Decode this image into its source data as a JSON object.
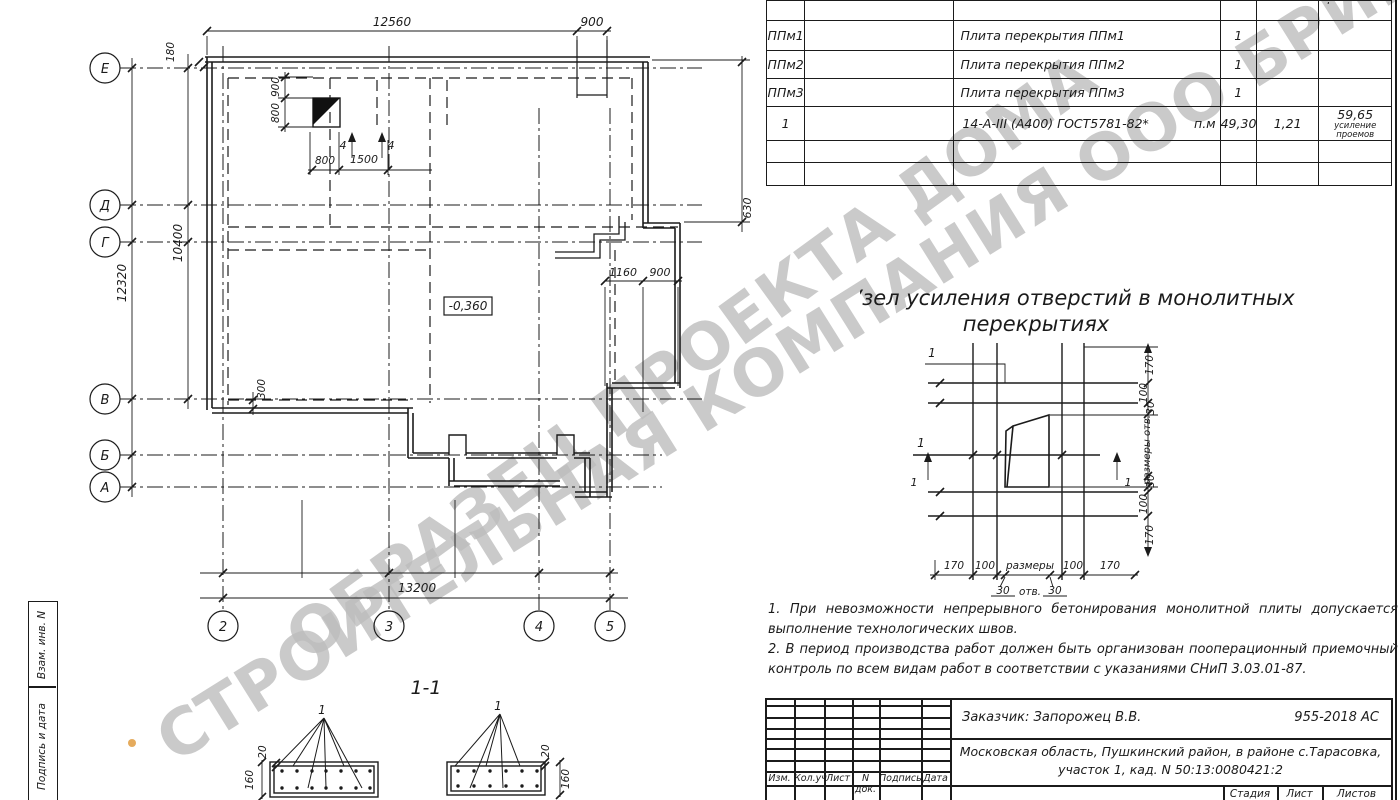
{
  "watermark": {
    "line1": "ОБРАЗЕЦ ПРОЕКТА ДОМА",
    "line2": "СТРОИТЕЛЬНАЯ КОМПАНИЯ ООО БРИКХАУЗ"
  },
  "frame": {
    "strip_top_label": "Взам. инв. N",
    "strip_bottom_label": "Подпись и дата"
  },
  "plan": {
    "row_axes": [
      "Е",
      "Д",
      "Г",
      "В",
      "Б",
      "А"
    ],
    "col_axes": [
      "2",
      "3",
      "4",
      "5"
    ],
    "dims": {
      "top": "12560",
      "top_right": "900",
      "top_left": "180",
      "left_outer": "12320",
      "left_inner": "10400",
      "bottom": "13200",
      "opening_v1": "900",
      "opening_v2": "800",
      "opening_h1": "800",
      "opening_h2": "1500",
      "bay1": "1160",
      "bay2": "900",
      "right_offset": "630",
      "step": "300"
    },
    "level": "-0,360",
    "section_mark": "4"
  },
  "section": {
    "title": "1-1",
    "mark": "1",
    "cover": "20",
    "height": "160"
  },
  "spec_table": {
    "headers": {
      "col1": "Поз.",
      "col2": "Обозначение",
      "col3": "Наименование",
      "col4": "Кол.",
      "col5_line1": "Масса",
      "col5_line2": "ед. кг",
      "col6": "Примечание"
    },
    "rows": [
      {
        "pos": "ППм1",
        "dsg": "",
        "name": "Плита перекрытия ППм1",
        "unit": "",
        "qty": "1",
        "mass": "",
        "note1": "",
        "note2": ""
      },
      {
        "pos": "ППм2",
        "dsg": "",
        "name": "Плита перекрытия ППм2",
        "unit": "",
        "qty": "1",
        "mass": "",
        "note1": "",
        "note2": ""
      },
      {
        "pos": "ППм3",
        "dsg": "",
        "name": "Плита перекрытия ППм3",
        "unit": "",
        "qty": "1",
        "mass": "",
        "note1": "",
        "note2": ""
      },
      {
        "pos": "1",
        "dsg": "",
        "name": "14-А-III (А400) ГОСТ5781-82*",
        "unit": "п.м",
        "qty": "49,30",
        "mass": "1,21",
        "note1": "59,65",
        "note2": "усиление проемов"
      },
      {
        "pos": "",
        "dsg": "",
        "name": "",
        "unit": "",
        "qty": "",
        "mass": "",
        "note1": "",
        "note2": ""
      },
      {
        "pos": "",
        "dsg": "",
        "name": "",
        "unit": "",
        "qty": "",
        "mass": "",
        "note1": "",
        "note2": ""
      }
    ]
  },
  "detail": {
    "title1": "Узел усиления отверстий в монолитных",
    "title2": "перекрытиях",
    "mark": "1",
    "d170": "170",
    "d100": "100",
    "d30": "30",
    "sizes": "размеры",
    "otv": "отв.",
    "sizes_otv": "размеры отв."
  },
  "notes": {
    "n1": "1. При невозможности непрерывного бетонирования монолитной плиты допускается выполнение технологических швов.",
    "n2": "2. В период производства работ должен быть организован пооперационный приемочный контроль по всем видам работ в соответствии с указаниями СНиП 3.03.01-87."
  },
  "title_block": {
    "customer": "Заказчик: Запорожец В.В.",
    "code": "955-2018 АС",
    "address_line1": "Московская область, Пушкинский район, в районе с.Тарасовка,",
    "address_line2": "участок 1, кад. N 50:13:0080421:2",
    "col_izm": "Изм.",
    "col_koluch": "Кол.уч",
    "col_list": "Лист",
    "col_ndok": "N док.",
    "col_podpis": "Подпись",
    "col_data": "Дата",
    "stage": "Стадия",
    "sheet": "Лист",
    "sheets": "Листов"
  }
}
